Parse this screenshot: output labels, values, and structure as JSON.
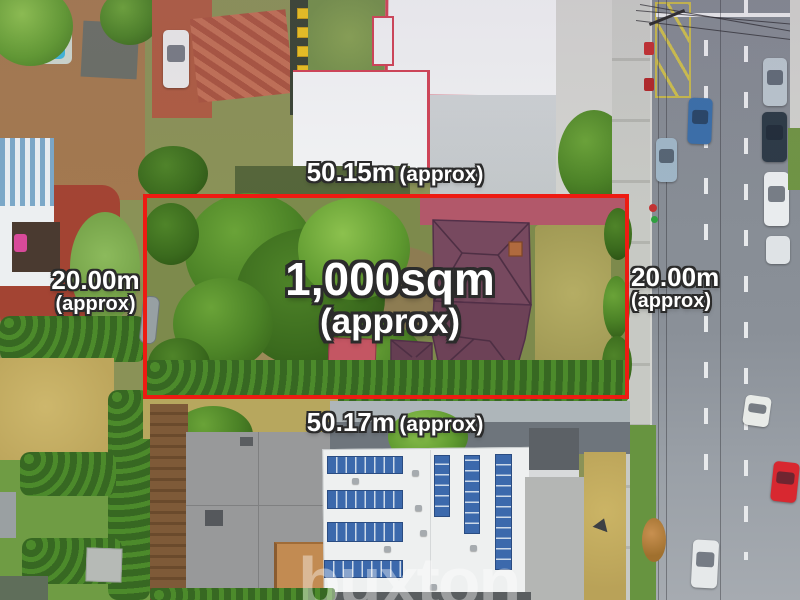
{
  "annotations": {
    "boundary_color": "#ee1b12",
    "text_color": "#ffffff",
    "outline_color": "#2b2b2b",
    "top": {
      "value": "50.15m",
      "qualifier": "(approx)"
    },
    "bottom": {
      "value": "50.17m",
      "qualifier": "(approx)"
    },
    "left": {
      "value": "20.00m",
      "qualifier": "(approx)"
    },
    "right": {
      "value": "20.00m",
      "qualifier": "(approx)"
    },
    "area": {
      "value": "1,000sqm",
      "qualifier": "(approx)"
    }
  },
  "watermark": {
    "text": "buxton",
    "color": "rgba(255,255,255,0.40)"
  }
}
